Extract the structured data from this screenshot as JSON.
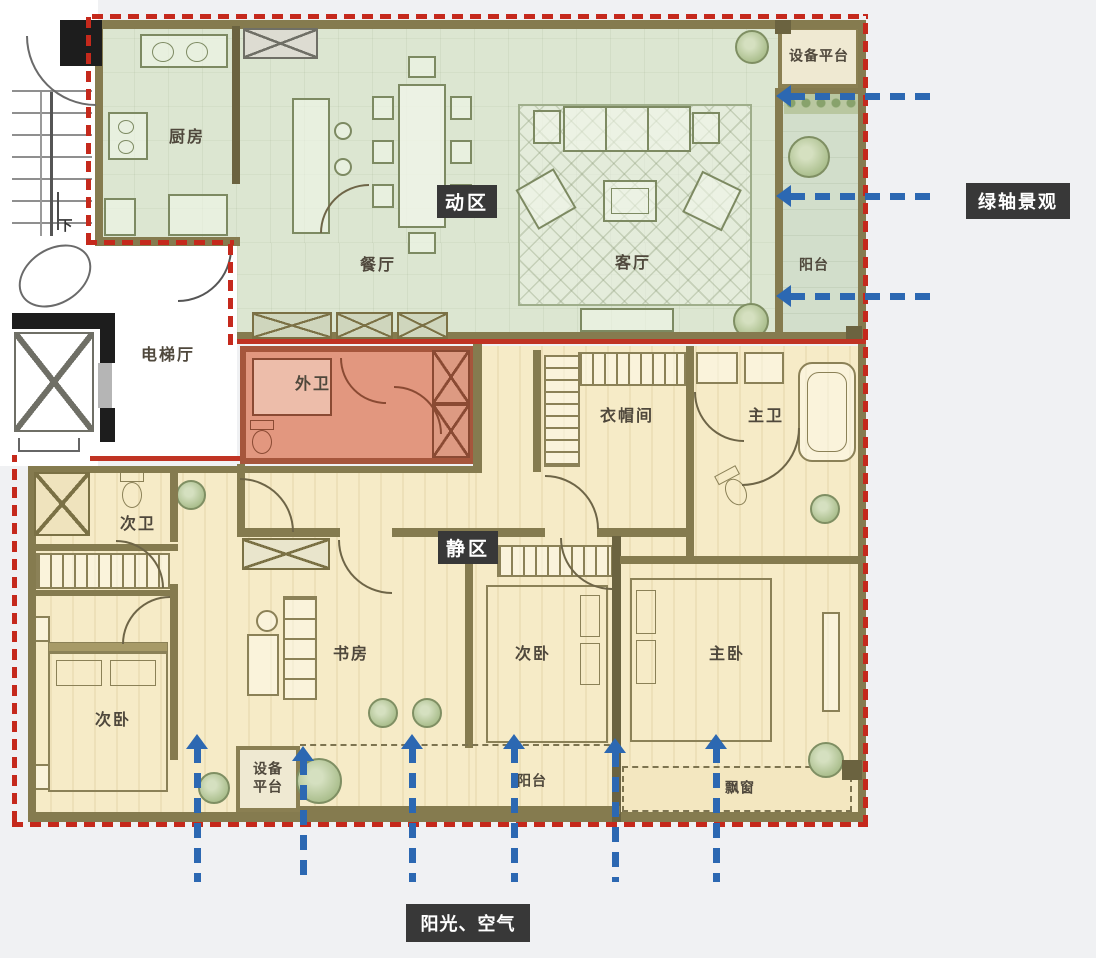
{
  "zones": {
    "active": {
      "label": "动区",
      "color": "#dce6d1"
    },
    "quiet": {
      "label": "静区",
      "color": "#f6ebc7"
    },
    "guest_bath_zone": {
      "label": "外卫",
      "color": "#e2977f"
    }
  },
  "rooms": {
    "kitchen": "厨房",
    "dining": "餐厅",
    "living": "客厅",
    "balcony_top": "阳台",
    "equipment_top": "设备平台",
    "elevator_hall": "电梯厅",
    "guest_bath": "外卫",
    "cloakroom": "衣帽间",
    "master_bath": "主卫",
    "second_bath": "次卫",
    "bedroom_left": "次卧",
    "study": "书房",
    "bedroom_mid": "次卧",
    "master_bedroom": "主卧",
    "equipment_bottom": "设备平台",
    "balcony_bottom": "阳台",
    "bay_window": "飘窗",
    "stairs_down": "下"
  },
  "callouts": {
    "green_axis": "绿轴景观",
    "sun_air": "阳光、空气"
  },
  "colors": {
    "boundary_red": "#c5291c",
    "arrow_blue": "#2c68b2",
    "badge_bg": "#383838",
    "wall_olive": "#857b4f",
    "zone_active": "#dce6d1",
    "zone_quiet": "#f6ebc7",
    "zone_guest_bath": "#e2977f"
  }
}
